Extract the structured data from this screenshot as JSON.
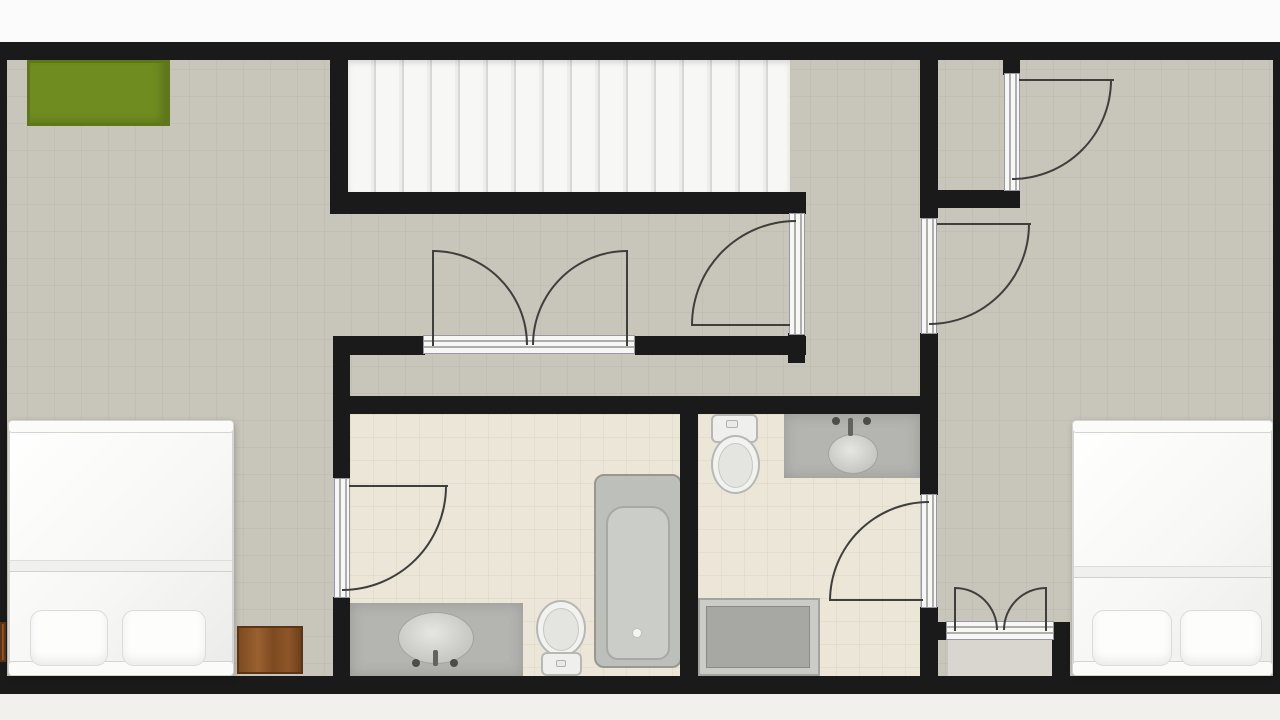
{
  "meta": {
    "type": "residential-floor-plan",
    "storey": "upper floor with staircase, 2 bedrooms, 2 bathrooms, hallway, closets"
  },
  "canvas": {
    "w": 1280,
    "h": 720
  },
  "palette": {
    "wall": "#1a1a1a",
    "floor_main": "#c8c6bb",
    "floor_bathroom": "#ebe6d8",
    "floor_closet": "#d8d6cf",
    "stairs": "#f5f5f3",
    "rug_green": "#6f8c20",
    "wood_brown": "#7d4a20",
    "fixture_gray": "#b4b4b0",
    "bed_white": "#fafaf8",
    "door_line": "#3e3e3c",
    "outside_top": "#fbfbfb",
    "outside_bottom": "#f2f0ed"
  },
  "shapes": [
    {
      "n": "outside-margin-top",
      "c": "outside",
      "x": 0,
      "y": 0,
      "w": 1280,
      "h": 42
    },
    {
      "n": "outside-margin-bottom",
      "c": "outside-b",
      "x": 0,
      "y": 694,
      "w": 1280,
      "h": 26
    },
    {
      "n": "main-floor",
      "c": "floor-main",
      "x": 0,
      "y": 42,
      "w": 1280,
      "h": 652
    },
    {
      "n": "bathroom1-floor",
      "c": "floor-tile",
      "x": 350,
      "y": 414,
      "w": 330,
      "h": 262
    },
    {
      "n": "bathroom2-floor",
      "c": "floor-tile",
      "x": 698,
      "y": 414,
      "w": 222,
      "h": 262
    },
    {
      "n": "closet-floor",
      "c": "floor-closet",
      "x": 948,
      "y": 640,
      "w": 104,
      "h": 36
    },
    {
      "n": "staircase",
      "c": "stairs",
      "x": 348,
      "y": 60,
      "w": 442,
      "h": 132
    },
    {
      "n": "green-rug",
      "c": "rug",
      "x": 27,
      "y": 60,
      "w": 143,
      "h": 66
    },
    {
      "n": "vanity1-counter",
      "c": "vanity",
      "x": 350,
      "y": 603,
      "w": 173,
      "h": 73
    },
    {
      "n": "vanity1-sink",
      "c": "sink",
      "x": 398,
      "y": 612,
      "w": 76,
      "h": 52
    },
    {
      "n": "vanity1-faucet",
      "c": "faucet",
      "x": 433,
      "y": 650,
      "w": 5,
      "h": 16
    },
    {
      "n": "vanity1-handle-left",
      "c": "dot",
      "x": 412,
      "y": 659,
      "w": 8,
      "h": 8
    },
    {
      "n": "vanity1-handle-right",
      "c": "dot",
      "x": 450,
      "y": 659,
      "w": 8,
      "h": 8
    },
    {
      "n": "toilet1-bowl",
      "c": "toilet-bowl",
      "x": 536,
      "y": 600,
      "w": 50,
      "h": 57
    },
    {
      "n": "toilet1-seat",
      "c": "toilet-inner",
      "x": 543,
      "y": 608,
      "w": 36,
      "h": 43
    },
    {
      "n": "toilet1-tank",
      "c": "toilet-tank",
      "x": 541,
      "y": 652,
      "w": 41,
      "h": 24
    },
    {
      "n": "toilet1-flush-button",
      "c": "dot-light",
      "x": 556,
      "y": 660,
      "w": 10,
      "h": 7
    },
    {
      "n": "bathtub",
      "c": "tub",
      "x": 594,
      "y": 474,
      "w": 88,
      "h": 194
    },
    {
      "n": "bathtub-basin",
      "c": "tub-inner",
      "x": 606,
      "y": 506,
      "w": 64,
      "h": 154
    },
    {
      "n": "bathtub-drain",
      "c": "drain",
      "x": 632,
      "y": 628,
      "w": 10,
      "h": 10
    },
    {
      "n": "toilet2-tank",
      "c": "toilet-tank",
      "x": 711,
      "y": 414,
      "w": 47,
      "h": 29
    },
    {
      "n": "toilet2-flush-button",
      "c": "dot-light",
      "x": 726,
      "y": 420,
      "w": 12,
      "h": 8
    },
    {
      "n": "toilet2-bowl",
      "c": "toilet-bowl",
      "x": 711,
      "y": 435,
      "w": 49,
      "h": 59
    },
    {
      "n": "toilet2-seat",
      "c": "toilet-inner",
      "x": 718,
      "y": 443,
      "w": 35,
      "h": 45
    },
    {
      "n": "vanity2-counter",
      "c": "vanity",
      "x": 784,
      "y": 414,
      "w": 136,
      "h": 64
    },
    {
      "n": "vanity2-sink",
      "c": "sink",
      "x": 828,
      "y": 434,
      "w": 50,
      "h": 40
    },
    {
      "n": "vanity2-faucet",
      "c": "faucet",
      "x": 848,
      "y": 418,
      "w": 5,
      "h": 18
    },
    {
      "n": "vanity2-handle-left",
      "c": "dot",
      "x": 832,
      "y": 417,
      "w": 8,
      "h": 8
    },
    {
      "n": "vanity2-handle-right",
      "c": "dot",
      "x": 863,
      "y": 417,
      "w": 8,
      "h": 8
    },
    {
      "n": "shower-tray",
      "c": "shower",
      "x": 698,
      "y": 598,
      "w": 122,
      "h": 78
    },
    {
      "n": "shower-base",
      "c": "shower-inner",
      "x": 706,
      "y": 606,
      "w": 104,
      "h": 62
    },
    {
      "n": "wall-outer-top",
      "c": "wall",
      "x": 0,
      "y": 42,
      "w": 1280,
      "h": 18
    },
    {
      "n": "wall-outer-bottom",
      "c": "wall",
      "x": 0,
      "y": 676,
      "w": 1280,
      "h": 18
    },
    {
      "n": "wall-outer-left",
      "c": "wall",
      "x": 0,
      "y": 42,
      "w": 7,
      "h": 652
    },
    {
      "n": "wall-outer-right",
      "c": "wall",
      "x": 1273,
      "y": 42,
      "w": 7,
      "h": 652
    },
    {
      "n": "wall-stair-left",
      "c": "wall",
      "x": 330,
      "y": 60,
      "w": 18,
      "h": 150
    },
    {
      "n": "wall-stair-bottom",
      "c": "wall",
      "x": 330,
      "y": 192,
      "w": 476,
      "h": 22
    },
    {
      "n": "wall-bedroom1-upper",
      "c": "wall",
      "x": 333,
      "y": 337,
      "w": 17,
      "h": 141
    },
    {
      "n": "wall-bedroom1-lower",
      "c": "wall",
      "x": 333,
      "y": 597,
      "w": 17,
      "h": 79
    },
    {
      "n": "wall-hall-left-of-doors",
      "c": "wall",
      "x": 333,
      "y": 336,
      "w": 92,
      "h": 19
    },
    {
      "n": "wall-hall-right-of-doors",
      "c": "wall",
      "x": 635,
      "y": 336,
      "w": 171,
      "h": 19
    },
    {
      "n": "wall-below-hall-door",
      "c": "wall",
      "x": 788,
      "y": 333,
      "w": 17,
      "h": 30
    },
    {
      "n": "wall-bathrooms-top",
      "c": "wall",
      "x": 333,
      "y": 396,
      "w": 605,
      "h": 18
    },
    {
      "n": "wall-bath-divider",
      "c": "wall",
      "x": 680,
      "y": 414,
      "w": 18,
      "h": 262
    },
    {
      "n": "wall-right-corridor-top",
      "c": "wall",
      "x": 920,
      "y": 60,
      "w": 18,
      "h": 158
    },
    {
      "n": "wall-vestibule-bottom",
      "c": "wall",
      "x": 920,
      "y": 190,
      "w": 100,
      "h": 18
    },
    {
      "n": "wall-vestibule-door-stub",
      "c": "wall",
      "x": 1003,
      "y": 52,
      "w": 17,
      "h": 23
    },
    {
      "n": "wall-right-corridor-mid",
      "c": "wall",
      "x": 920,
      "y": 333,
      "w": 18,
      "h": 162
    },
    {
      "n": "wall-right-corridor-low",
      "c": "wall",
      "x": 920,
      "y": 607,
      "w": 18,
      "h": 69
    },
    {
      "n": "wall-closet-stub-left",
      "c": "wall",
      "x": 938,
      "y": 622,
      "w": 12,
      "h": 18
    },
    {
      "n": "wall-closet-right",
      "c": "wall",
      "x": 1052,
      "y": 622,
      "w": 18,
      "h": 54
    },
    {
      "n": "double-door-threshold",
      "c": "frame-h",
      "x": 423,
      "y": 335,
      "w": 212,
      "h": 19
    },
    {
      "n": "hallway-door-frame",
      "c": "frame-v",
      "x": 789,
      "y": 213,
      "w": 16,
      "h": 122
    },
    {
      "n": "bedroom2-door-frame",
      "c": "frame-v",
      "x": 921,
      "y": 218,
      "w": 16,
      "h": 116
    },
    {
      "n": "vestibule-closet-door-frame",
      "c": "frame-v",
      "x": 1004,
      "y": 73,
      "w": 16,
      "h": 118
    },
    {
      "n": "bathroom1-door-frame",
      "c": "frame-v",
      "x": 334,
      "y": 478,
      "w": 16,
      "h": 120
    },
    {
      "n": "bathroom2-door-frame",
      "c": "frame-v",
      "x": 921,
      "y": 494,
      "w": 16,
      "h": 114
    },
    {
      "n": "closet-double-door-threshold",
      "c": "frame-h",
      "x": 946,
      "y": 621,
      "w": 108,
      "h": 19
    },
    {
      "n": "double-door-left-swing-arc",
      "c": "arc arc-tr",
      "x": 433,
      "y": 250,
      "w": 95,
      "h": 95
    },
    {
      "n": "double-door-right-swing-arc",
      "c": "arc arc-tl",
      "x": 532,
      "y": 250,
      "w": 95,
      "h": 95
    },
    {
      "n": "hallway-door-swing-arc",
      "c": "arc arc-tl",
      "x": 691,
      "y": 220,
      "w": 105,
      "h": 105
    },
    {
      "n": "bedroom2-door-swing-arc",
      "c": "arc arc-br",
      "x": 929,
      "y": 224,
      "w": 101,
      "h": 101
    },
    {
      "n": "vestibule-closet-door-swing-arc",
      "c": "arc arc-br",
      "x": 1012,
      "y": 80,
      "w": 100,
      "h": 100
    },
    {
      "n": "bathroom1-door-swing-arc",
      "c": "arc arc-br",
      "x": 342,
      "y": 486,
      "w": 105,
      "h": 105
    },
    {
      "n": "bathroom2-door-swing-arc",
      "c": "arc arc-tl",
      "x": 829,
      "y": 501,
      "w": 100,
      "h": 100
    },
    {
      "n": "closet-left-swing-arc",
      "c": "arc arc-tr",
      "x": 955,
      "y": 587,
      "w": 43,
      "h": 43
    },
    {
      "n": "closet-right-swing-arc",
      "c": "arc arc-tl",
      "x": 1003,
      "y": 587,
      "w": 43,
      "h": 43
    },
    {
      "n": "double-door-left-leaf",
      "c": "leaf",
      "x": 432,
      "y": 250,
      "w": 2,
      "h": 96
    },
    {
      "n": "double-door-right-leaf",
      "c": "leaf",
      "x": 626,
      "y": 250,
      "w": 2,
      "h": 96
    },
    {
      "n": "hallway-door-leaf",
      "c": "leaf",
      "x": 691,
      "y": 324,
      "w": 99,
      "h": 2
    },
    {
      "n": "bedroom2-door-leaf",
      "c": "leaf",
      "x": 937,
      "y": 223,
      "w": 94,
      "h": 2
    },
    {
      "n": "vestibule-closet-door-leaf",
      "c": "leaf",
      "x": 1019,
      "y": 79,
      "w": 95,
      "h": 2
    },
    {
      "n": "bathroom1-door-leaf",
      "c": "leaf",
      "x": 349,
      "y": 485,
      "w": 99,
      "h": 2
    },
    {
      "n": "bathroom2-door-leaf",
      "c": "leaf",
      "x": 830,
      "y": 599,
      "w": 93,
      "h": 2
    },
    {
      "n": "closet-left-leaf",
      "c": "leaf",
      "x": 954,
      "y": 587,
      "w": 2,
      "h": 44
    },
    {
      "n": "closet-right-leaf",
      "c": "leaf",
      "x": 1045,
      "y": 587,
      "w": 2,
      "h": 44
    },
    {
      "n": "bed-left",
      "c": "bed",
      "x": 8,
      "y": 420,
      "w": 226,
      "h": 256
    },
    {
      "n": "bed-left-headboard",
      "c": "bed-board",
      "x": 8,
      "y": 420,
      "w": 226,
      "h": 13
    },
    {
      "n": "bed-left-fold",
      "c": "bed-fold",
      "x": 10,
      "y": 560,
      "w": 222,
      "h": 12
    },
    {
      "n": "bed-left-footboard",
      "c": "bed-board",
      "x": 8,
      "y": 661,
      "w": 226,
      "h": 15
    },
    {
      "n": "bed-left-pillow-1",
      "c": "pillow",
      "x": 30,
      "y": 610,
      "w": 78,
      "h": 56
    },
    {
      "n": "bed-left-pillow-2",
      "c": "pillow",
      "x": 122,
      "y": 610,
      "w": 84,
      "h": 56
    },
    {
      "n": "nightstand",
      "c": "wood",
      "x": 237,
      "y": 626,
      "w": 66,
      "h": 48
    },
    {
      "n": "nightstand-edge-sliver",
      "c": "wood",
      "x": 0,
      "y": 622,
      "w": 6,
      "h": 40
    },
    {
      "n": "bed-right",
      "c": "bed",
      "x": 1072,
      "y": 420,
      "w": 201,
      "h": 256
    },
    {
      "n": "bed-right-headboard",
      "c": "bed-board",
      "x": 1072,
      "y": 420,
      "w": 201,
      "h": 13
    },
    {
      "n": "bed-right-fold",
      "c": "bed-fold",
      "x": 1074,
      "y": 566,
      "w": 197,
      "h": 12
    },
    {
      "n": "bed-right-footboard",
      "c": "bed-board",
      "x": 1072,
      "y": 661,
      "w": 201,
      "h": 15
    },
    {
      "n": "bed-right-pillow-1",
      "c": "pillow",
      "x": 1092,
      "y": 610,
      "w": 80,
      "h": 56
    },
    {
      "n": "bed-right-pillow-2",
      "c": "pillow",
      "x": 1180,
      "y": 610,
      "w": 82,
      "h": 56
    }
  ]
}
